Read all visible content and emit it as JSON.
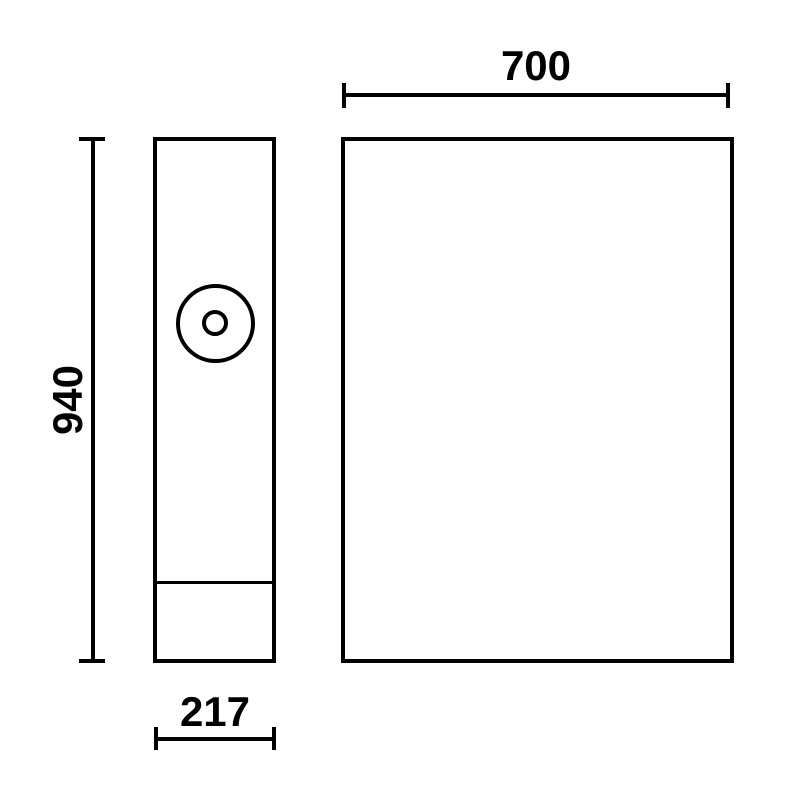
{
  "drawing": {
    "background_color": "#ffffff",
    "line_color": "#000000",
    "dimensions": {
      "height": "940",
      "width": "700",
      "depth": "217"
    }
  }
}
